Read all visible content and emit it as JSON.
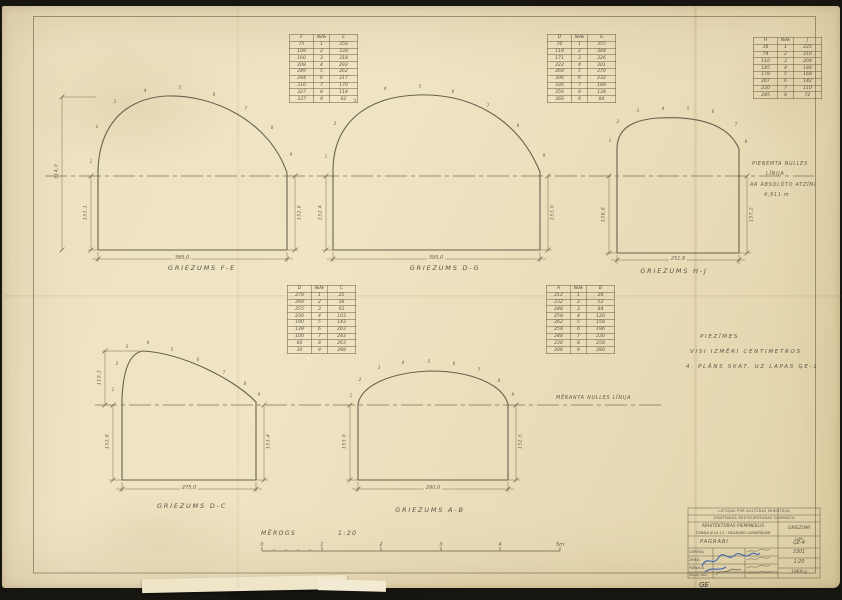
{
  "colors": {
    "paper": "#ebe0bf",
    "ink": "#5c5342",
    "dim": "#7a6c52",
    "signature_blue": "#3f63ae"
  },
  "zero_lines": {
    "top": {
      "line1": "PIEŅEMTA NULLES",
      "line2": "LĪNIJA",
      "line3": "AR ABSOLŪTO ATZĪMI",
      "line4": "4,911 m"
    },
    "bottom": {
      "label": "MĒRANTA NULLES LĪNIJA"
    }
  },
  "notes": {
    "line1": "PIEZĪMES",
    "line2": "VISI IZMĒRI CENTIMETROS",
    "line3": "4. PLĀNS SKAT. UZ LAPAS ĢE-1"
  },
  "scale_bar": {
    "label": "MĒROGS",
    "ratio": "1:20",
    "ticks": [
      "0",
      "1",
      "2",
      "3",
      "4",
      "5m"
    ]
  },
  "sections": [
    {
      "label": "GRIEZUMS F-E",
      "width_dim": "385,0",
      "left_outer_dim": "314,0",
      "left_dim": "153,1",
      "right_dim": "152,6",
      "points": [
        "1",
        "2",
        "3",
        "4",
        "5",
        "6",
        "7",
        "8",
        "9"
      ]
    },
    {
      "label": "GRIEZUMS D-G",
      "width_dim": "395,0",
      "left_dim": "152,4",
      "right_dim": "153,0",
      "points": [
        "1",
        "2",
        "3",
        "4",
        "5",
        "6",
        "7",
        "8",
        "9"
      ]
    },
    {
      "label": "GRIEZUMS H-J",
      "width_dim": "251,8",
      "left_dim": "156,8",
      "right_dim": "157,2",
      "points": [
        "1",
        "2",
        "3",
        "4",
        "5",
        "6",
        "7",
        "8"
      ]
    },
    {
      "label": "GRIEZUMS D-C",
      "width_dim": "275,0",
      "left_outer_dim": "110,3",
      "left_dim": "152,8",
      "right_dim": "153,4",
      "points": [
        "1",
        "2",
        "3",
        "4",
        "5",
        "6",
        "7",
        "8",
        "9"
      ]
    },
    {
      "label": "GRIEZUMS A-B",
      "width_dim": "290,0",
      "left_dim": "153,0",
      "right_dim": "152,5",
      "points": [
        "1",
        "2",
        "3",
        "4",
        "5",
        "6",
        "7",
        "8",
        "9"
      ]
    }
  ],
  "tables": [
    {
      "header": [
        "F",
        "№№",
        "E"
      ],
      "rows": [
        [
          "75",
          "1",
          "350"
        ],
        [
          "109",
          "2",
          "338"
        ],
        [
          "160",
          "3",
          "318"
        ],
        [
          "208",
          "4",
          "292"
        ],
        [
          "249",
          "5",
          "262"
        ],
        [
          "284",
          "6",
          "217"
        ],
        [
          "310",
          "7",
          "170"
        ],
        [
          "327",
          "8",
          "118"
        ],
        [
          "337",
          "9",
          "62"
        ]
      ]
    },
    {
      "header": [
        "D",
        "№№",
        "G"
      ],
      "rows": [
        [
          "70",
          "1",
          "355"
        ],
        [
          "118",
          "2",
          "344"
        ],
        [
          "171",
          "3",
          "326"
        ],
        [
          "222",
          "4",
          "301"
        ],
        [
          "268",
          "5",
          "270"
        ],
        [
          "306",
          "6",
          "232"
        ],
        [
          "336",
          "7",
          "188"
        ],
        [
          "356",
          "8",
          "138"
        ],
        [
          "366",
          "9",
          "84"
        ]
      ]
    },
    {
      "header": [
        "H",
        "№№",
        "J"
      ],
      "rows": [
        [
          "38",
          "1",
          "225"
        ],
        [
          "74",
          "2",
          "216"
        ],
        [
          "110",
          "3",
          "204"
        ],
        [
          "145",
          "4",
          "188"
        ],
        [
          "178",
          "5",
          "168"
        ],
        [
          "207",
          "6",
          "142"
        ],
        [
          "230",
          "7",
          "110"
        ],
        [
          "245",
          "8",
          "72"
        ]
      ]
    },
    {
      "header": [
        "D",
        "№№",
        "C"
      ],
      "rows": [
        [
          "278",
          "1",
          "21"
        ],
        [
          "269",
          "2",
          "36"
        ],
        [
          "255",
          "3",
          "63"
        ],
        [
          "230",
          "4",
          "103"
        ],
        [
          "190",
          "5",
          "143"
        ],
        [
          "138",
          "6",
          "203"
        ],
        [
          "100",
          "7",
          "243"
        ],
        [
          "60",
          "8",
          "263"
        ],
        [
          "30",
          "9",
          "288"
        ]
      ]
    },
    {
      "header": [
        "A",
        "№№",
        "B"
      ],
      "rows": [
        [
          "212",
          "1",
          "28"
        ],
        [
          "232",
          "2",
          "52"
        ],
        [
          "248",
          "3",
          "84"
        ],
        [
          "258",
          "4",
          "120"
        ],
        [
          "262",
          "5",
          "158"
        ],
        [
          "258",
          "6",
          "196"
        ],
        [
          "248",
          "7",
          "230"
        ],
        [
          "230",
          "8",
          "258"
        ],
        [
          "206",
          "9",
          "280"
        ]
      ]
    }
  ],
  "title_block": {
    "org_line1": "LATVIJAS PSR KULTŪRAS MINISTRIJA",
    "org_line2": "ZINĀTNISKĀ RESTAURĒŠANAS DARBNĪCA",
    "object_line1": "ARHITEKTŪRAS PIEMINEKLIS",
    "object_line2": "TORŅA IELA 11 · PAGRABU UZMĒRĪJUMI",
    "subject": "PAGRABI",
    "content_label": "GRIEZUMI",
    "sheet_label": "LAPA",
    "sheet_no": "ĢE-4",
    "order_no": "3301",
    "scale": "1:20",
    "date": "1969.g",
    "roles": [
      "UZMĒRĪJA",
      "ZĪMĒJA",
      "PĀRBAUD.",
      "DAĻAS VAD."
    ]
  },
  "corner_mark": "ĢE"
}
